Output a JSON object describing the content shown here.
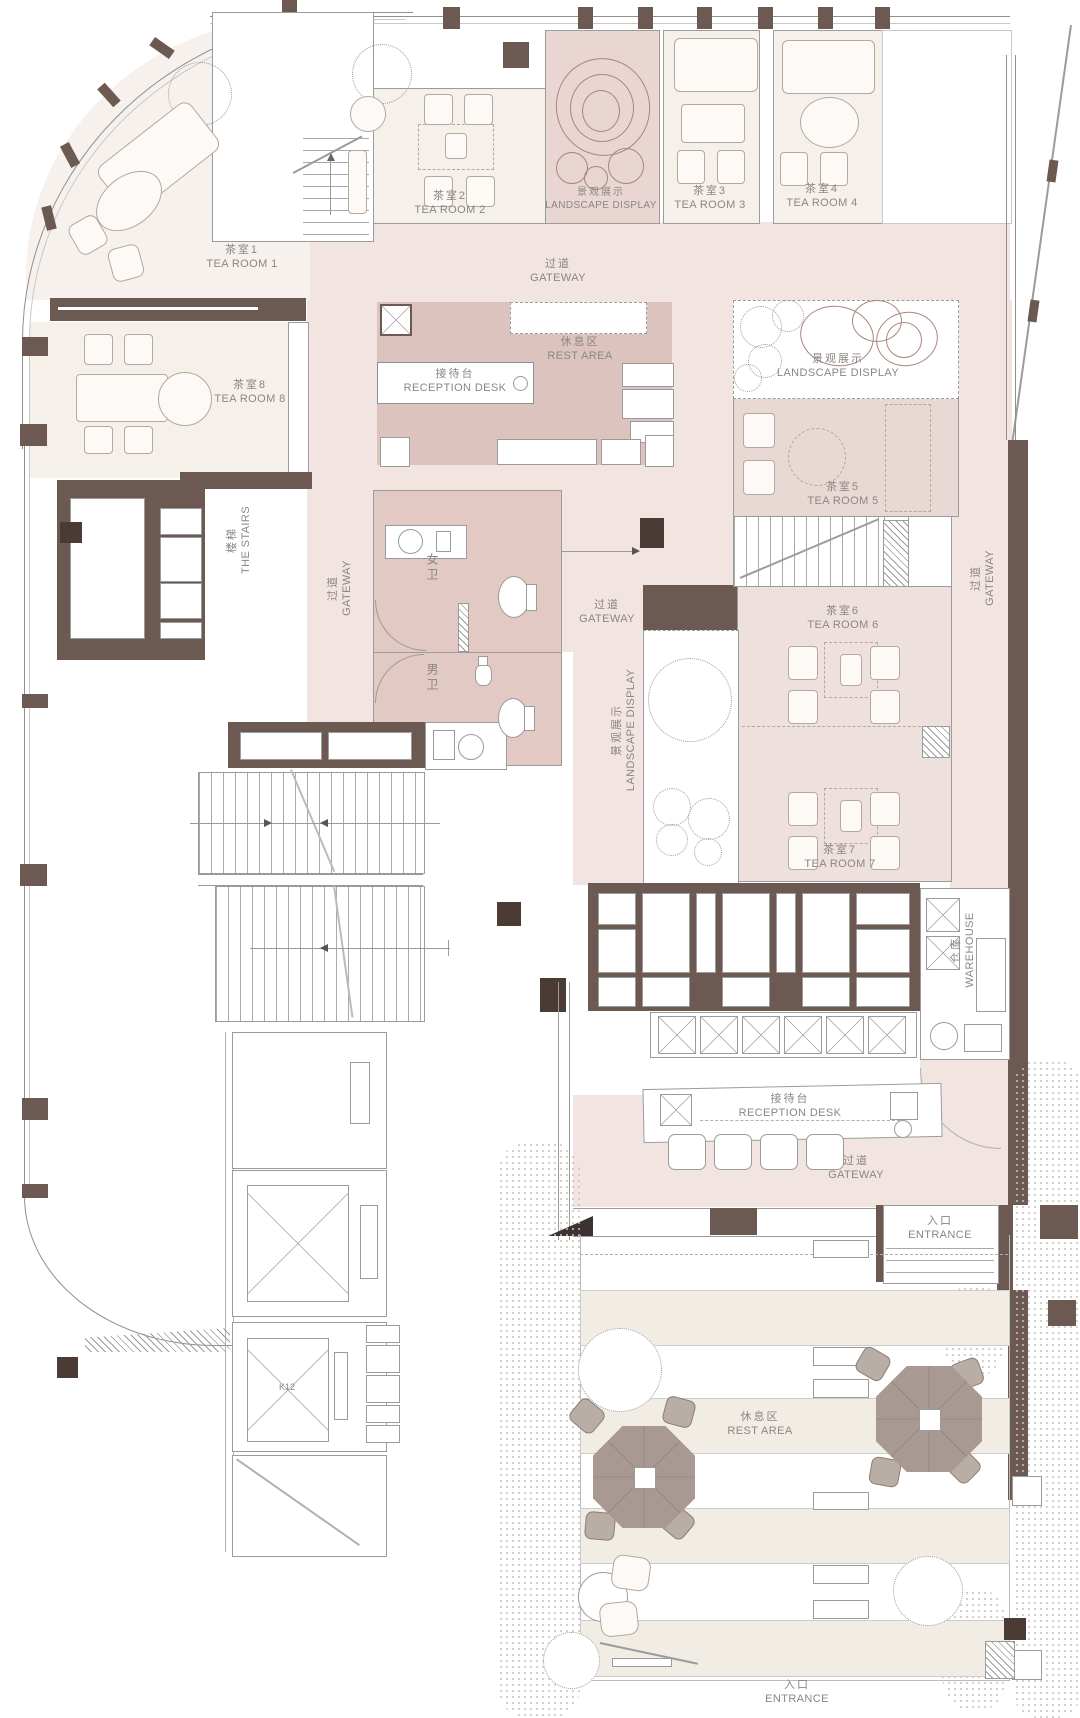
{
  "meta": {
    "title": "茶馆平面图 Tea House Floor Plan",
    "width": 1080,
    "height": 1718
  },
  "colors": {
    "wall": "#6c5a52",
    "wall_dark": "#4a3c35",
    "corridor": "#f2e4e1",
    "reception": "#dcc3be",
    "toilet": "#e3c9c4",
    "room": "#f6f0eb",
    "room_warm": "#f7f1ed",
    "tea5": "#e9d9d5",
    "tea67": "#eee1dd",
    "landscape": "#e9d5d2",
    "outdoor": "#f1ece4",
    "line": "#9b9b9b",
    "furniture": "#b5a89d",
    "label": "#8a8684",
    "umbrella": "#a89a92",
    "umbrella_dark": "#8a7d75",
    "greenery": "#cfc9c4"
  },
  "labels": {
    "tea_room_1": {
      "zh": "茶室1",
      "en": "TEA ROOM 1"
    },
    "tea_room_2": {
      "zh": "茶室2",
      "en": "TEA ROOM 2"
    },
    "tea_room_3": {
      "zh": "茶室3",
      "en": "TEA ROOM 3"
    },
    "tea_room_4": {
      "zh": "茶室4",
      "en": "TEA ROOM 4"
    },
    "tea_room_5": {
      "zh": "茶室5",
      "en": "TEA ROOM 5"
    },
    "tea_room_6": {
      "zh": "茶室6",
      "en": "TEA ROOM 6"
    },
    "tea_room_7": {
      "zh": "茶室7",
      "en": "TEA ROOM 7"
    },
    "tea_room_8": {
      "zh": "茶室8",
      "en": "TEA ROOM 8"
    },
    "landscape_display_top": {
      "zh": "景观展示",
      "en": "LANDSCAPE DISPLAY"
    },
    "landscape_display_right": {
      "zh": "景观展示",
      "en": "LANDSCAPE DISPLAY"
    },
    "landscape_display_mid": {
      "zh": "景观展示",
      "en": "LANDSCAPE DISPLAY"
    },
    "gateway_top": {
      "zh": "过道",
      "en": "GATEWAY"
    },
    "gateway_left": {
      "zh": "过道",
      "en": "GATEWAY"
    },
    "gateway_mid": {
      "zh": "过道",
      "en": "GATEWAY"
    },
    "gateway_right": {
      "zh": "过道",
      "en": "GATEWAY"
    },
    "gateway_bottom": {
      "zh": "过道",
      "en": "GATEWAY"
    },
    "rest_area_top": {
      "zh": "休息区",
      "en": "REST AREA"
    },
    "rest_area_outdoor": {
      "zh": "休息区",
      "en": "REST AREA"
    },
    "reception_top": {
      "zh": "接待台",
      "en": "RECEPTION DESK"
    },
    "reception_bottom": {
      "zh": "接待台",
      "en": "RECEPTION DESK"
    },
    "stairs": {
      "zh": "楼梯",
      "en": "THE STAIRS"
    },
    "toilet_women": {
      "zh": "女卫"
    },
    "toilet_men": {
      "zh": "男卫"
    },
    "warehouse": {
      "zh": "仓库",
      "en": "WAREHOUSE"
    },
    "entrance_right": {
      "zh": "入口",
      "en": "ENTRANCE"
    },
    "entrance_bottom": {
      "zh": "入口",
      "en": "ENTRANCE"
    },
    "elevator": {
      "code": "K12"
    }
  }
}
